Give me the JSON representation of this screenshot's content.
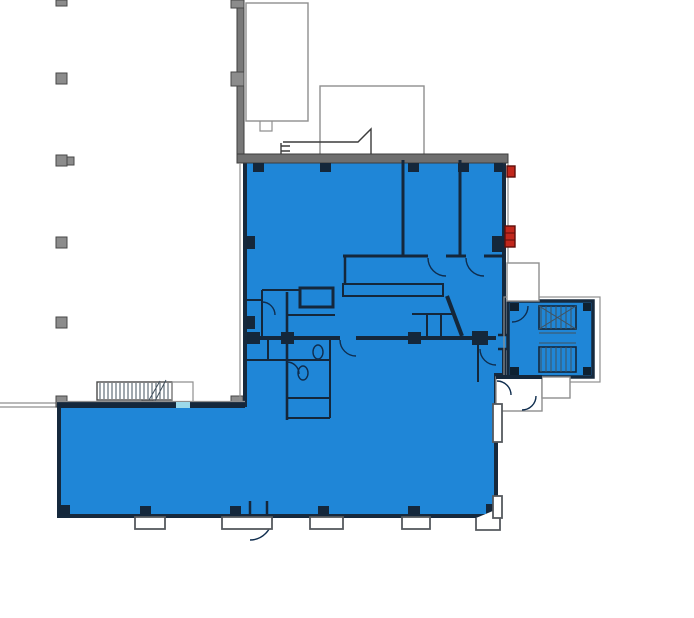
{
  "plan": {
    "type": "architectural-floor-plan",
    "regions": [
      {
        "name": "highlighted-footprint",
        "selected": true
      },
      {
        "name": "stair-tower",
        "selected": true
      },
      {
        "name": "external-staircase"
      },
      {
        "name": "neighboring-buildings"
      },
      {
        "name": "structural-grid-columns"
      },
      {
        "name": "fire-equipment-markers"
      },
      {
        "name": "window-bays"
      },
      {
        "name": "interior-partition-walls"
      },
      {
        "name": "door-swings"
      }
    ]
  },
  "colors": {
    "background": "#ffffff",
    "highlight": "#1f86d7",
    "highlight_dark": "#176fb4",
    "wall": "#14273b",
    "wall_corner": "#0e2132",
    "gray_wall": "#6f6f6f",
    "outline_gray": "#8f8f8f",
    "column_gray": "#8c8c8c",
    "red_marker": "#c1271c",
    "red_dark": "#5f0e0a",
    "door_cyan": "#9cd9ea",
    "white": "#ffffff"
  }
}
